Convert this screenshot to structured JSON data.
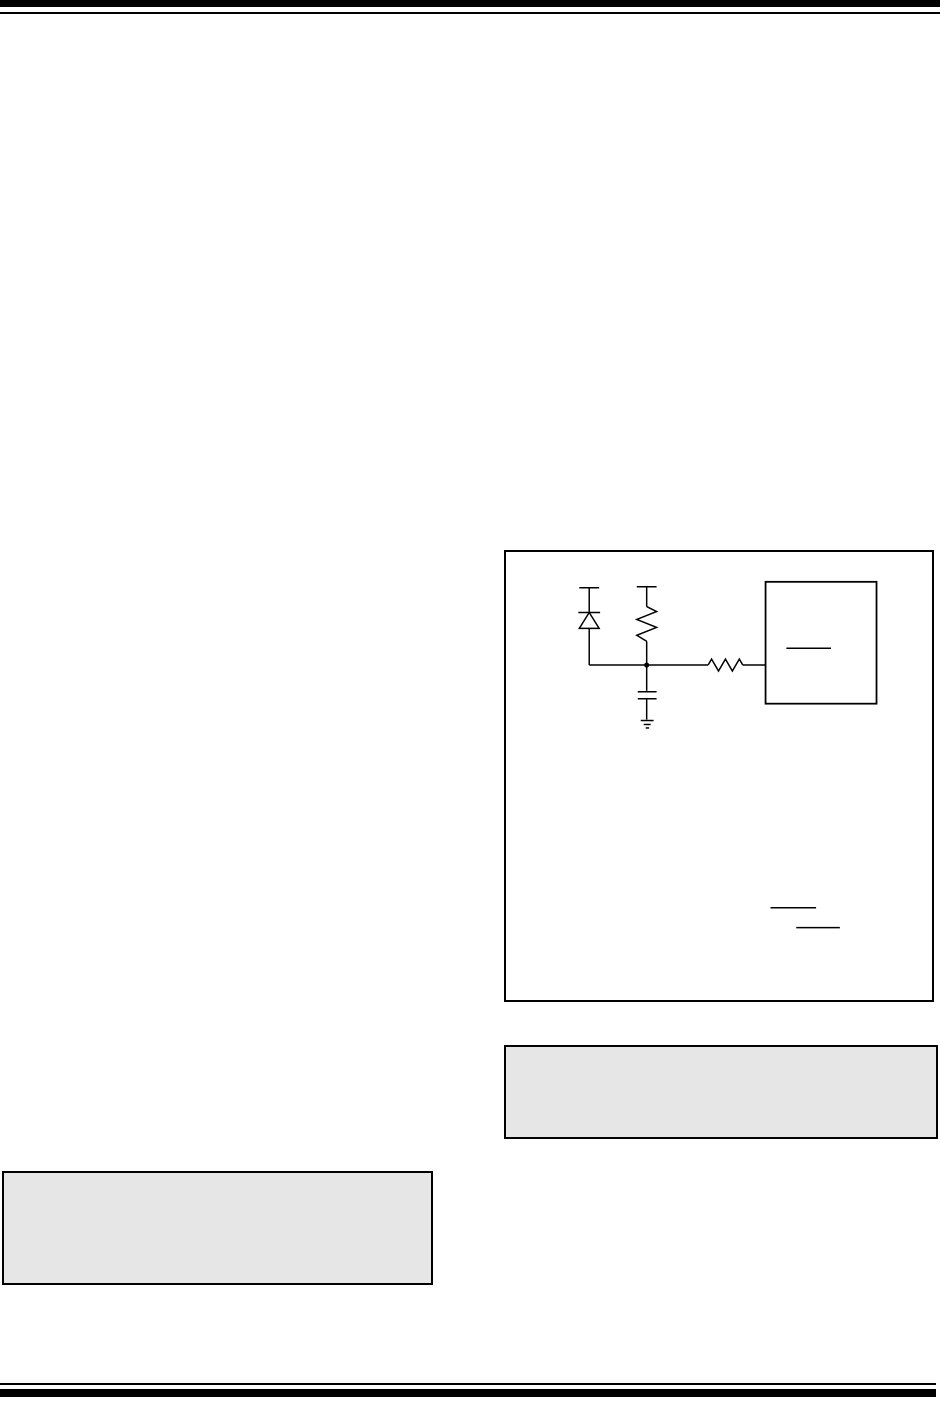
{
  "colors": {
    "page_bg": "#ffffff",
    "ink": "#000000",
    "note_fill": "#e6e6e6"
  },
  "page": {
    "kind": "datasheet-page",
    "visible_text": "",
    "rules": [
      "top-thick",
      "top-thin",
      "bottom-thin",
      "bottom-thick"
    ]
  },
  "figure": {
    "border_color": "#000000",
    "background": "#ffffff",
    "circuit": {
      "line_color": "#000000",
      "components": [
        "supply-tick-diode",
        "diode",
        "supply-tick-resistor",
        "pullup-resistor",
        "node-junction",
        "capacitor",
        "ground-symbol",
        "series-resistor",
        "ic-box",
        "pin-label-overline"
      ],
      "note_overline_count": 2
    }
  },
  "notes": {
    "fill": "#e6e6e6",
    "border_color": "#000000",
    "boxes": [
      "note-box-right",
      "note-box-left"
    ]
  }
}
